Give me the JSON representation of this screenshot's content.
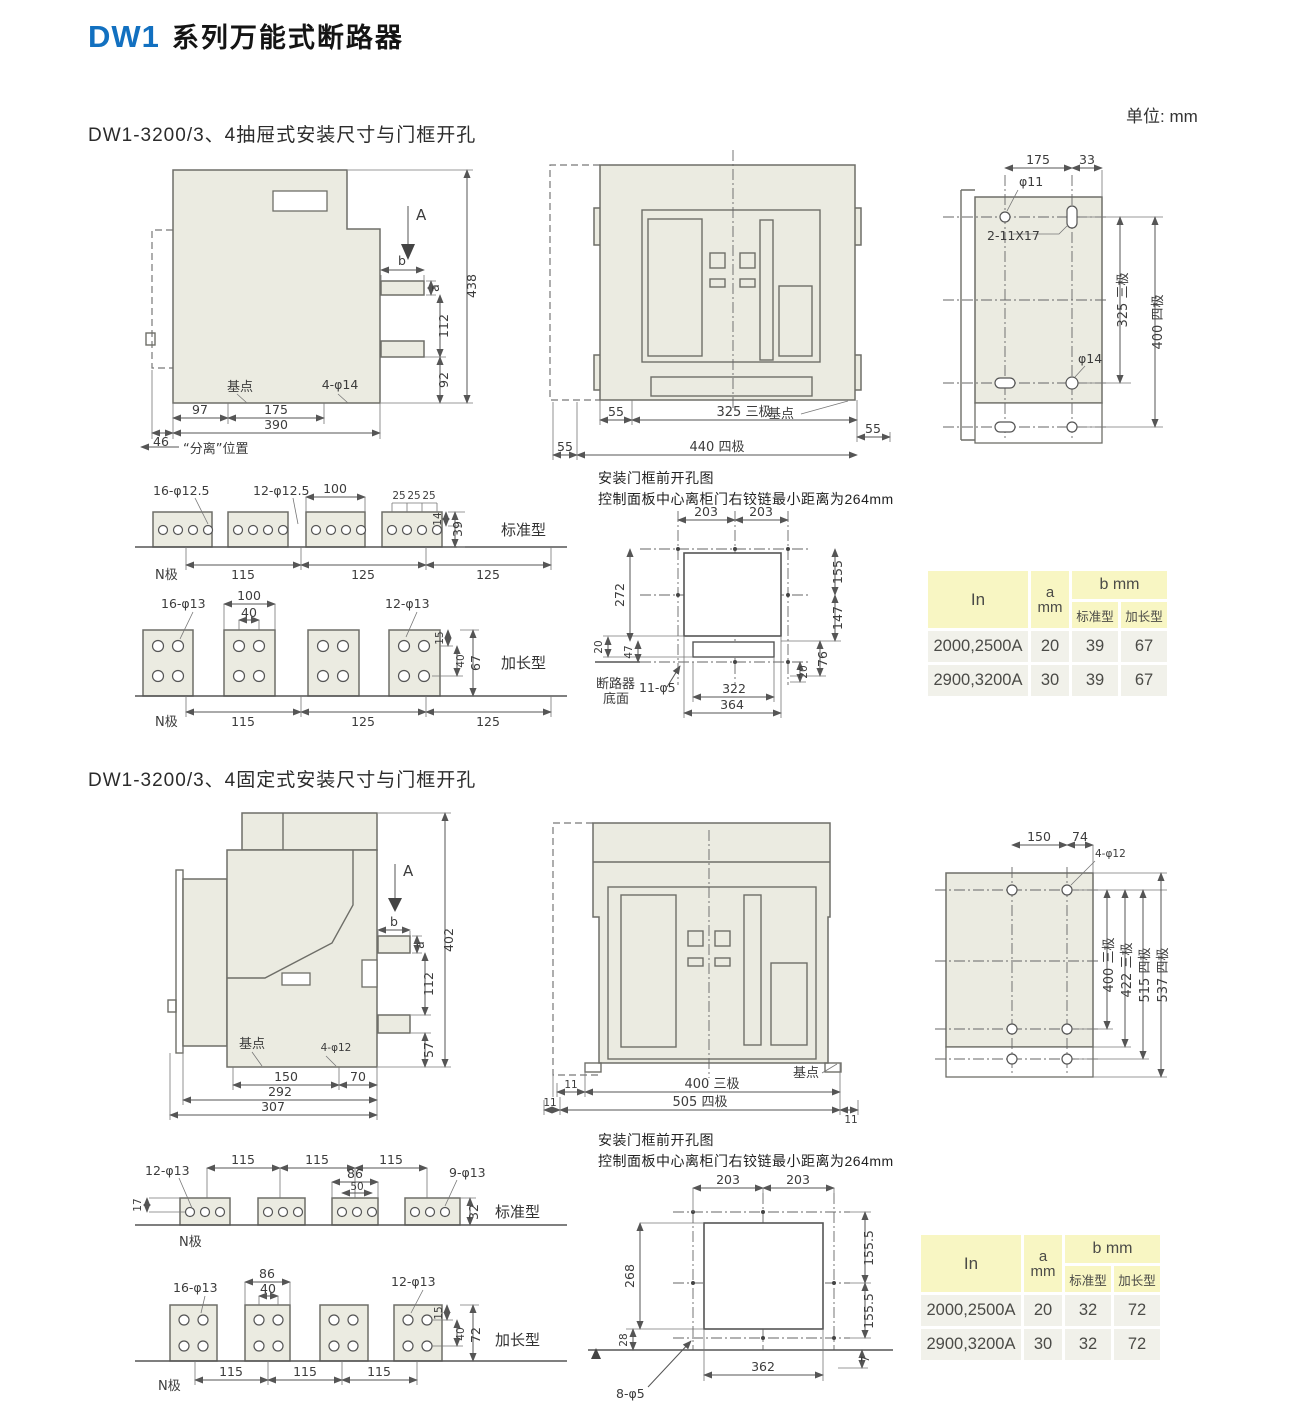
{
  "colors": {
    "brand_blue": "#1270c0",
    "drawing_fill": "#ebebe1",
    "table_header_bg": "#f8f6c3",
    "table_row_bg": "#f1f1ea"
  },
  "header": {
    "brand": "DW1",
    "title": "系列万能式断路器",
    "unit": "单位: mm"
  },
  "door_note": {
    "line1": "安装门框前开孔图",
    "line2": "控制面板中心离柜门右铰链最小距离为264mm"
  },
  "s1": {
    "heading": "DW1-3200/3、4抽屉式安装尺寸与门框开孔",
    "side": {
      "view_arrow": "A",
      "dim_b": "b",
      "dim_a": "a",
      "h_total": "438",
      "h_mid": "112",
      "h_bottom": "92",
      "base_label": "基点",
      "holes": "4-φ14",
      "w_97": "97",
      "w_175": "175",
      "w_390": "390",
      "w_46": "46",
      "separate": "“分离”位置"
    },
    "front": {
      "d55_left": "55",
      "d325": "325 三极",
      "d55_right": "55",
      "d55_far": "55",
      "d440": "440 四极",
      "base_label": "基点"
    },
    "plate": {
      "w_175": "175",
      "w_33": "33",
      "hole_top": "φ11",
      "slot": "2-11X17",
      "h_325": "325 三极",
      "h_400": "400 四极",
      "hole_bottom": "φ14"
    },
    "bus_std": {
      "holes_n": "16-φ12.5",
      "holes_p": "12-φ12.5",
      "w_100": "100",
      "w_25a": "25",
      "w_25b": "25",
      "w_25c": "25",
      "t_14": "14",
      "t_39": "39",
      "type_label": "标准型",
      "n_label": "N极",
      "p_115": "115",
      "p_125a": "125",
      "p_125b": "125"
    },
    "bus_ext": {
      "holes_n": "16-φ13",
      "holes_p": "12-φ13",
      "w_100": "100",
      "w_40": "40",
      "t_15": "15",
      "t_40": "40",
      "t_67": "67",
      "type_label": "加长型",
      "n_label": "N极",
      "p_115": "115",
      "p_125a": "125",
      "p_125b": "125"
    },
    "cutout": {
      "top_a": "203",
      "top_b": "203",
      "left_272": "272",
      "left_20": "20",
      "left_47": "47",
      "right_155": "155",
      "right_147": "147",
      "right_76": "76",
      "right_20": "20",
      "bot_322": "322",
      "bot_364": "364",
      "holes": "11-φ5",
      "note1": "断路器",
      "note2": "底面"
    },
    "table": {
      "col_in": "In",
      "col_a": "a",
      "col_mm": "mm",
      "col_b": "b mm",
      "col_std": "标准型",
      "col_ext": "加长型",
      "rows": [
        [
          "2000,2500A",
          "20",
          "39",
          "67"
        ],
        [
          "2900,3200A",
          "30",
          "39",
          "67"
        ]
      ]
    }
  },
  "s2": {
    "heading": "DW1-3200/3、4固定式安装尺寸与门框开孔",
    "side": {
      "view_arrow": "A",
      "dim_b": "b",
      "dim_a": "a",
      "h_total": "402",
      "h_mid": "112",
      "h_bottom": "57",
      "base_label": "基点",
      "holes": "4-φ12",
      "w_150": "150",
      "w_70": "70",
      "w_292": "292",
      "w_307": "307"
    },
    "front": {
      "d11_a": "11",
      "d400": "400 三极",
      "d11_b": "11",
      "d505": "505 四极",
      "d11_c": "11",
      "base_label": "基点"
    },
    "plate": {
      "w_150": "150",
      "w_74": "74",
      "holes": "4-φ12",
      "h_400": "400 三极",
      "h_422": "422 三极",
      "h_515": "515 四极",
      "h_537": "537 四极"
    },
    "bus_std": {
      "holes_n": "12-φ13",
      "t_17": "17",
      "p_115a": "115",
      "p_115b": "115",
      "p_115c": "115",
      "w_86": "86",
      "w_50": "50",
      "holes_p": "9-φ13",
      "t_32": "32",
      "type_label": "标准型",
      "n_label": "N极"
    },
    "bus_ext": {
      "w_86": "86",
      "w_40": "40",
      "holes_n": "16-φ13",
      "holes_p": "12-φ13",
      "t_15": "15",
      "t_40": "40",
      "t_72": "72",
      "type_label": "加长型",
      "n_label": "N极",
      "p_115a": "115",
      "p_115b": "115",
      "p_115c": "115"
    },
    "cutout": {
      "top_a": "203",
      "top_b": "203",
      "left_268": "268",
      "left_28": "28",
      "right_155a": "155.5",
      "right_155b": "155.5",
      "right_7": "7",
      "bot_362": "362",
      "holes": "8-φ5"
    },
    "table": {
      "col_in": "In",
      "col_a": "a",
      "col_mm": "mm",
      "col_b": "b mm",
      "col_std": "标准型",
      "col_ext": "加长型",
      "rows": [
        [
          "2000,2500A",
          "20",
          "32",
          "72"
        ],
        [
          "2900,3200A",
          "30",
          "32",
          "72"
        ]
      ]
    }
  }
}
